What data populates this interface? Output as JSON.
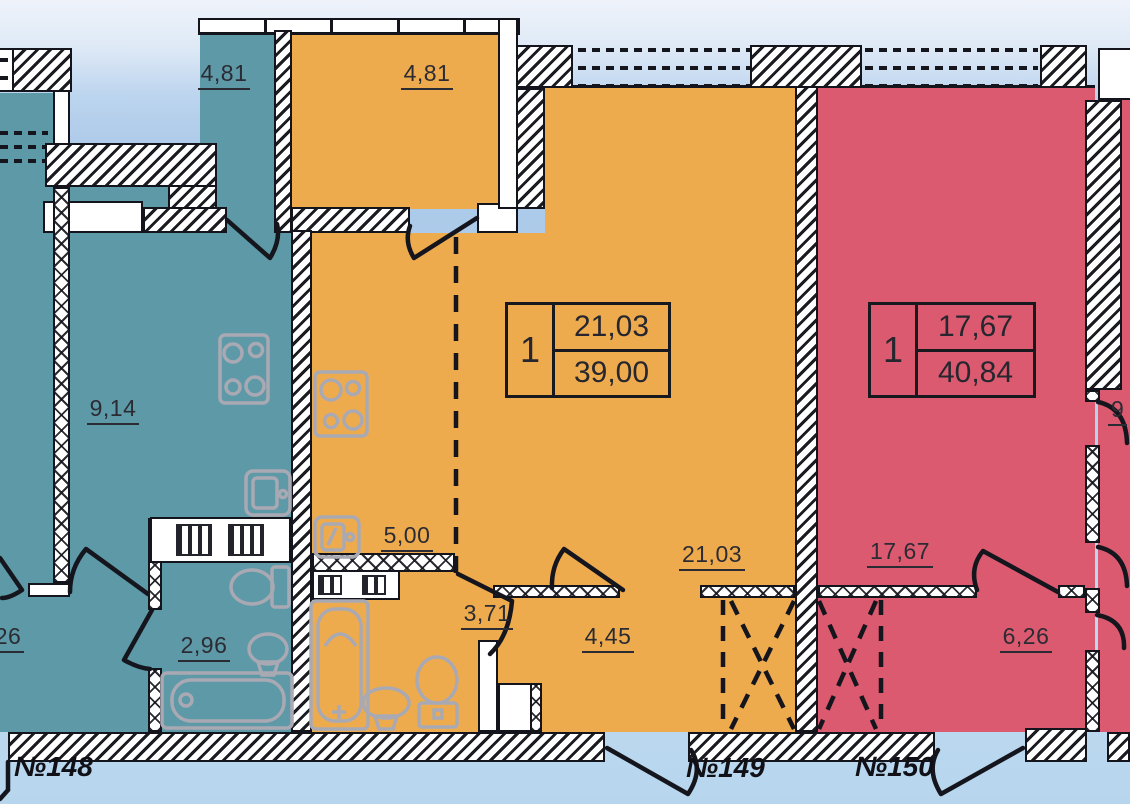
{
  "title": "floor-plan",
  "colors": {
    "teal": "#5E99A7",
    "orange": "#EEAB4D",
    "red": "#DC5A6F",
    "sky": "#A9C8E8",
    "wall_line": "#14141c",
    "fixture_gray": "#A9A9B4"
  },
  "apartments": {
    "a148": {
      "number": "№148",
      "balcony_area": "4,81",
      "room_area": "9,14",
      "bath_area": "2,96"
    },
    "a149": {
      "number": "№149",
      "rooms_count": "1",
      "living_area": "21,03",
      "total_area": "39,00",
      "balcony_area": "4,81",
      "kitchen_area": "5,00",
      "bath_area": "3,71",
      "hall_area": "4,45",
      "living_label": "21,03"
    },
    "a150": {
      "number": "№150",
      "rooms_count": "1",
      "living_area": "17,67",
      "total_area": "40,84",
      "living_label": "17,67",
      "hall_area": "6,26"
    },
    "left_partial_area": "26",
    "right_partial_area": "9"
  }
}
